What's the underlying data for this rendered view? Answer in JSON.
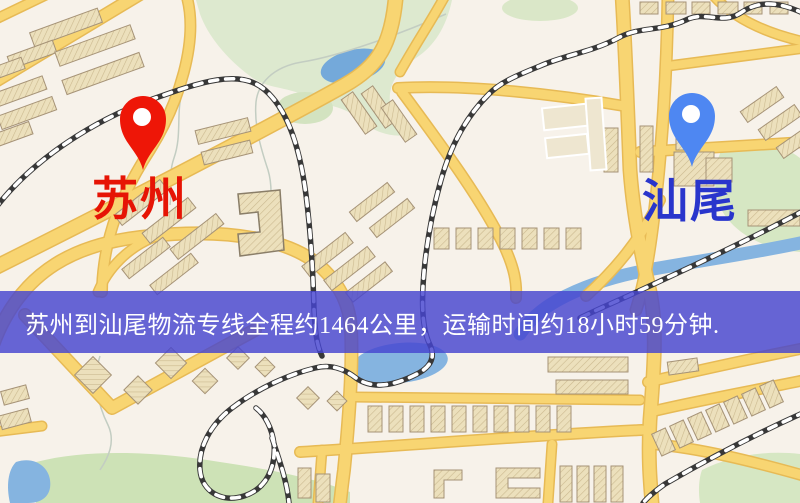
{
  "map": {
    "origin": {
      "name": "苏州",
      "pin_icon": "map-pin-icon",
      "pin_color": "#ee1607",
      "label_color": "#e61405"
    },
    "destination": {
      "name": "汕尾",
      "pin_icon": "map-pin-icon",
      "pin_color": "#4e87f2",
      "label_color": "#2935cc"
    },
    "banner": {
      "text": "苏州到汕尾物流专线全程约1464公里，运输时间约18小时59分钟.",
      "background_color": "rgba(70,68,208,0.82)",
      "text_color": "#ffffff"
    }
  }
}
